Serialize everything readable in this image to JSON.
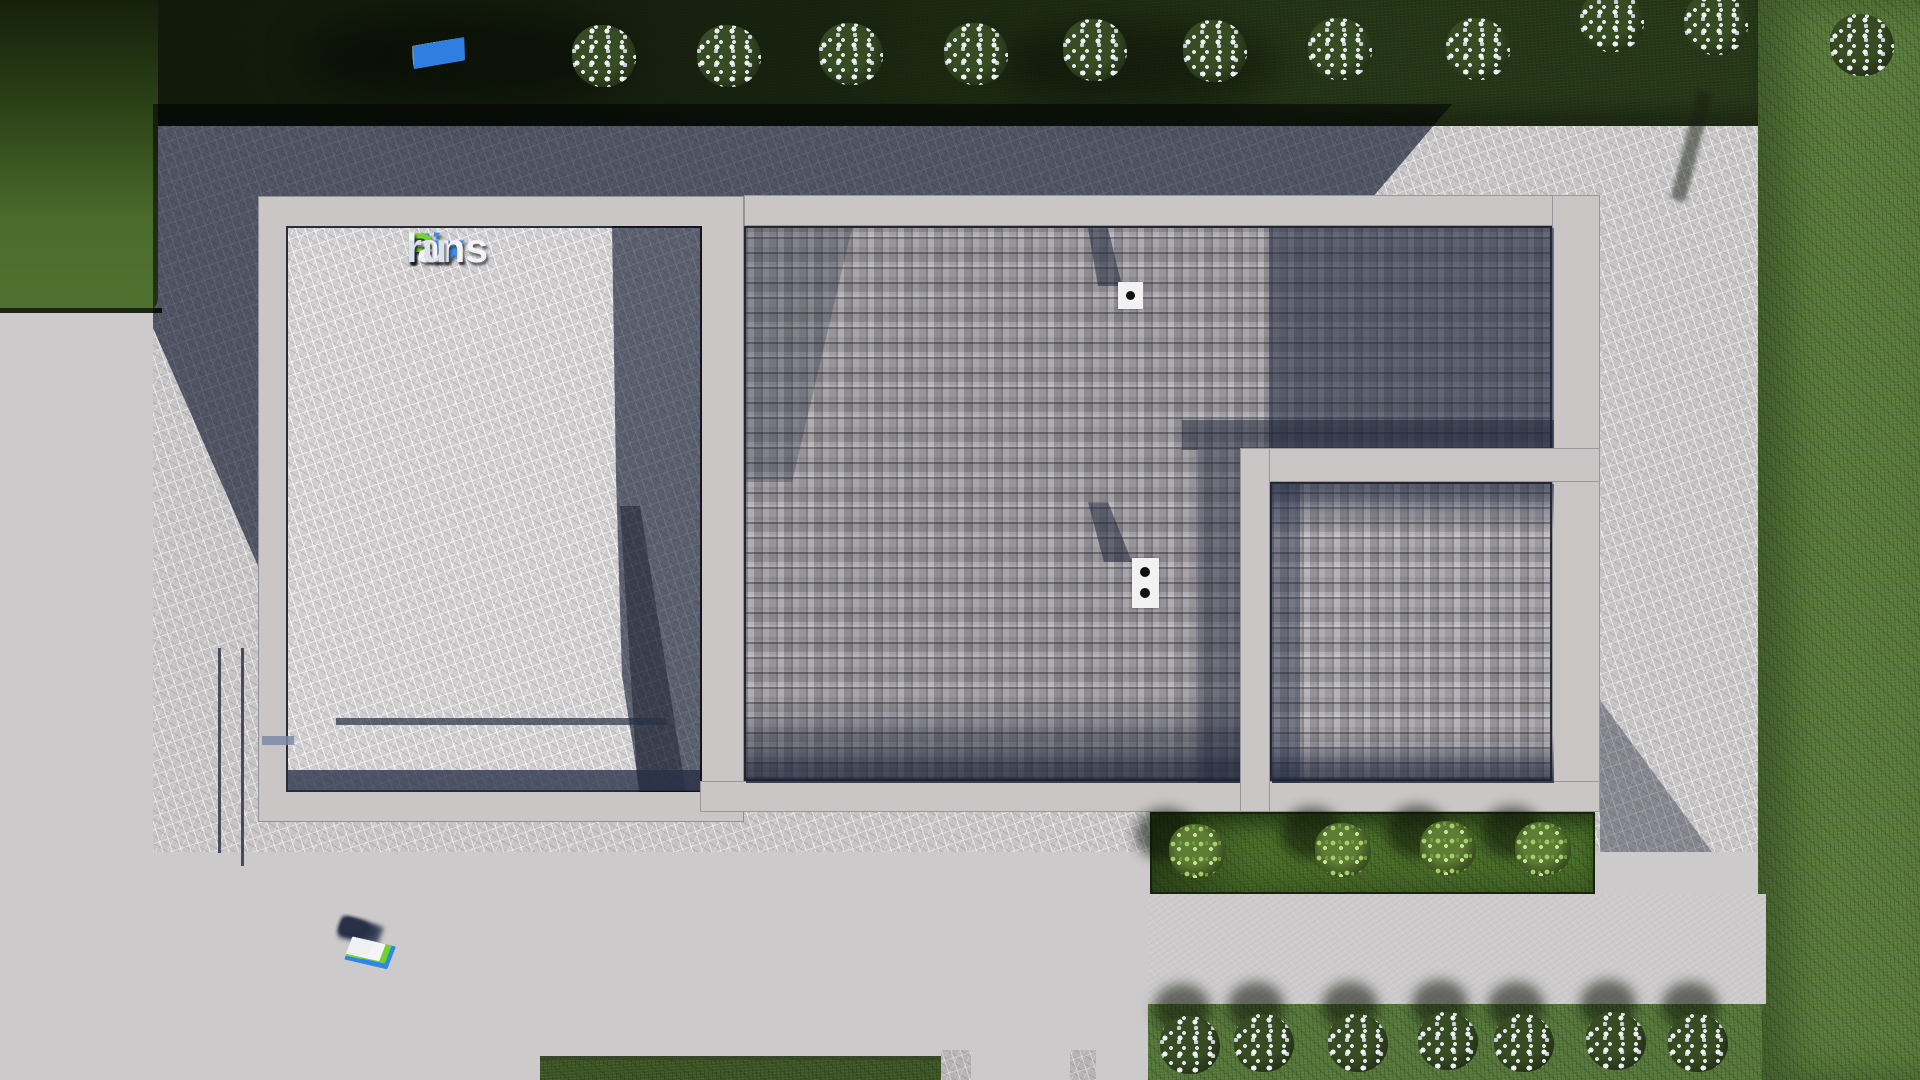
{
  "page": {
    "title": "FixPlans.ru — top view site plan render"
  },
  "logo": {
    "text": "FixPlans.ru",
    "segments": [
      {
        "text": "Fix",
        "color": "#3d8ee8"
      },
      {
        "text": "P",
        "color": "#73d629"
      },
      {
        "text": "lans",
        "color": "#f4f4f6"
      },
      {
        "text": ".",
        "color": "#2e7ee2"
      },
      {
        "text": "ru",
        "color": "#dde1ea"
      }
    ]
  },
  "watermarks": {
    "text": "FixPlans.ru",
    "top_blocks": [
      {
        "c": "#f2f3f5",
        "w": 30,
        "h": 15
      },
      {
        "c": "#e9ebee",
        "w": 16,
        "h": 15
      },
      {
        "c": "#f2f3f5",
        "w": 22,
        "h": 16
      },
      {
        "c": "#2f7fe0",
        "w": 24,
        "h": 17
      },
      {
        "c": "#f2f3f5",
        "w": 42,
        "h": 17
      },
      {
        "c": "#eef0f3",
        "w": 26,
        "h": 18
      },
      {
        "c": "#f4f5f7",
        "w": 36,
        "h": 18
      },
      {
        "c": "#f0f1f4",
        "w": 18,
        "h": 19
      },
      {
        "c": "#6ecf25",
        "w": 46,
        "h": 20
      },
      {
        "c": "#f4f5f7",
        "w": 34,
        "h": 20
      },
      {
        "c": "#eef0f3",
        "w": 24,
        "h": 21
      },
      {
        "c": "#6ecf25",
        "w": 20,
        "h": 21
      },
      {
        "c": "#2f7fe0",
        "w": 52,
        "h": 23
      }
    ],
    "bottom_blocks": [
      {
        "c": "#2f86e8",
        "w": 44,
        "h": 24
      },
      {
        "c": "#70d32a",
        "w": 16,
        "h": 20
      },
      {
        "c": "#f2f3f5",
        "w": 30,
        "h": 19
      },
      {
        "c": "#eef0f3",
        "w": 22,
        "h": 19
      },
      {
        "c": "#70d32a",
        "w": 40,
        "h": 19
      },
      {
        "c": "#f2f3f5",
        "w": 26,
        "h": 18
      },
      {
        "c": "#f4f5f7",
        "w": 34,
        "h": 18
      },
      {
        "c": "#eef0f3",
        "w": 26,
        "h": 17
      },
      {
        "c": "#f2f3f5",
        "w": 22,
        "h": 17
      },
      {
        "c": "#2f7fe0",
        "w": 14,
        "h": 16
      },
      {
        "c": "#f4f5f7",
        "w": 26,
        "h": 16
      },
      {
        "c": "#eef0f3",
        "w": 22,
        "h": 15
      }
    ]
  },
  "vegetation": {
    "top_bushes": [
      {
        "x": 604,
        "y": 57
      },
      {
        "x": 729,
        "y": 57
      },
      {
        "x": 851,
        "y": 55
      },
      {
        "x": 976,
        "y": 55
      },
      {
        "x": 1095,
        "y": 51
      },
      {
        "x": 1215,
        "y": 52
      },
      {
        "x": 1340,
        "y": 50
      },
      {
        "x": 1478,
        "y": 50
      },
      {
        "x": 1612,
        "y": 22
      },
      {
        "x": 1716,
        "y": 25
      },
      {
        "x": 1862,
        "y": 46
      }
    ],
    "bottom_bushes": [
      {
        "x": 1190,
        "y": 1046
      },
      {
        "x": 1264,
        "y": 1044
      },
      {
        "x": 1358,
        "y": 1044
      },
      {
        "x": 1448,
        "y": 1042
      },
      {
        "x": 1524,
        "y": 1044
      },
      {
        "x": 1616,
        "y": 1042
      },
      {
        "x": 1698,
        "y": 1044
      }
    ],
    "strip_bushes": [
      {
        "x": 1197,
        "y": 852
      },
      {
        "x": 1343,
        "y": 851
      },
      {
        "x": 1448,
        "y": 849
      },
      {
        "x": 1543,
        "y": 850
      }
    ]
  },
  "roof": {
    "chimney_small_dots": 1,
    "chimney_large_dots": 2
  },
  "palette": {
    "grass_dark": "#1d2a12",
    "grass_mid": "#4e7030",
    "grass_light": "#5b7d3b",
    "concrete": "#cccacb",
    "concrete_scratched": "#c6c4c5",
    "shadow_navy": "#3a4461",
    "frame": "#c9c6c5",
    "shingle": "#9f9ca1",
    "chimney": "#f2f2f2",
    "logo_blue": "#3d8ee8",
    "logo_green": "#73d629"
  }
}
